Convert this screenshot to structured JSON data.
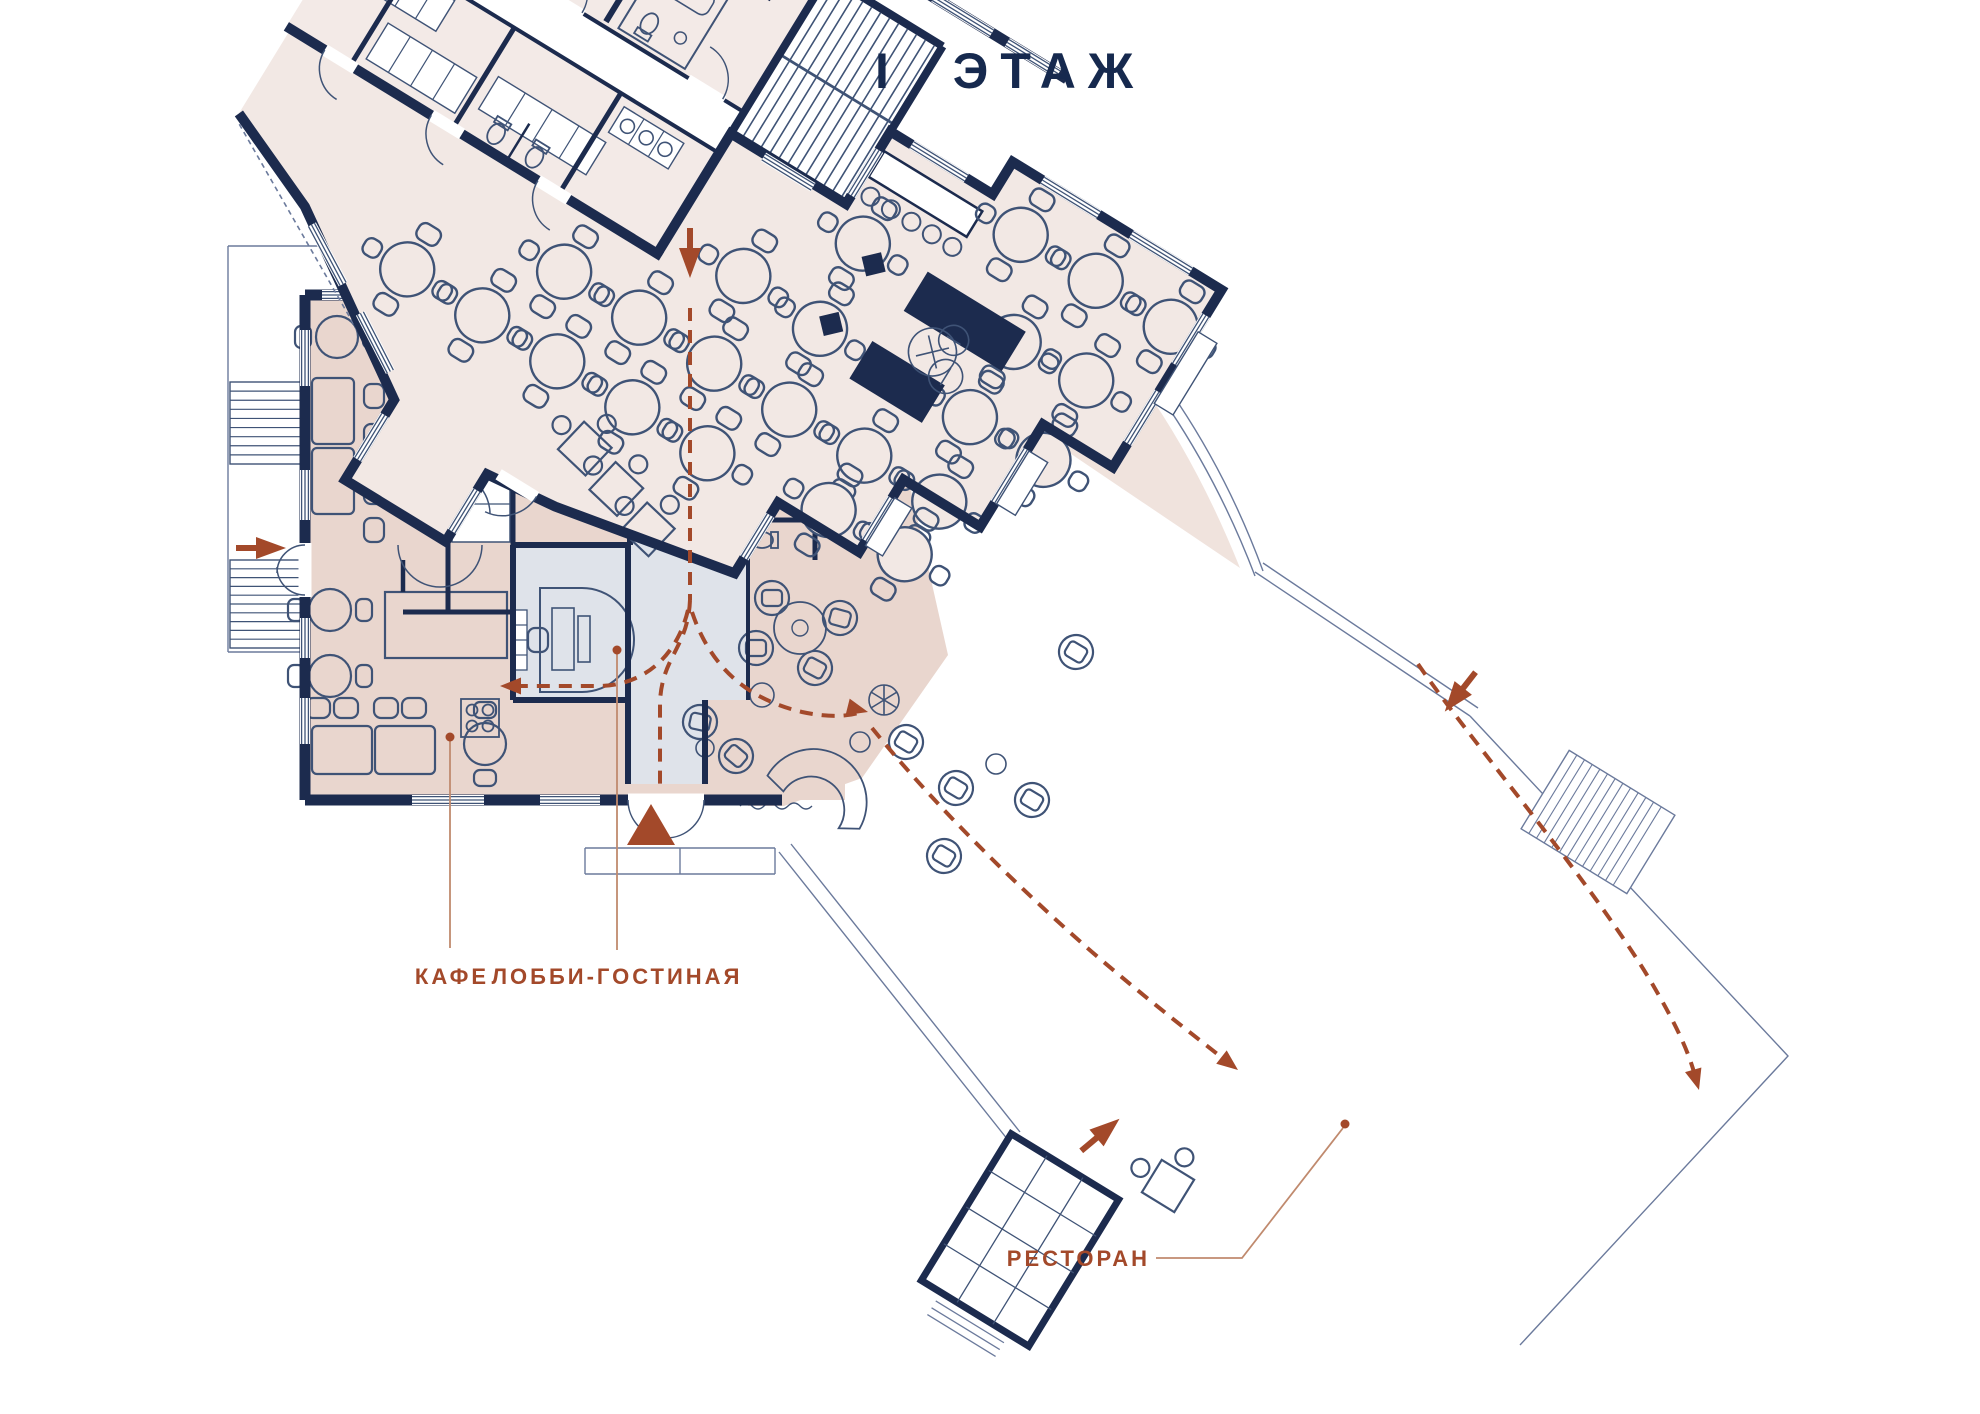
{
  "title": "I ЭТАЖ",
  "labels": {
    "cafe": "КАФЕ",
    "lobby": "ЛОББИ-ГОСТИНАЯ",
    "restaurant": "РЕСТОРАН"
  },
  "colors": {
    "walls": "#1c2b4e",
    "thin_line": "#3f5376",
    "outline_light": "#6b7a9c",
    "cafe_fill": "#e9d6ce",
    "lobby_fill": "#dfe3ea",
    "rooms_fill": "#f3eae7",
    "restaurant_fill": "#f2e8e4",
    "terrace_fill": "#f0e3dd",
    "accent": "#a3492a",
    "leader": "#c08a6e"
  },
  "annotations": {
    "entrance_arrows": [
      "top-entrance",
      "left-entrance",
      "right-entrance",
      "restaurant-entrance",
      "main-entrance-triangle"
    ],
    "leader_dots": 3
  }
}
